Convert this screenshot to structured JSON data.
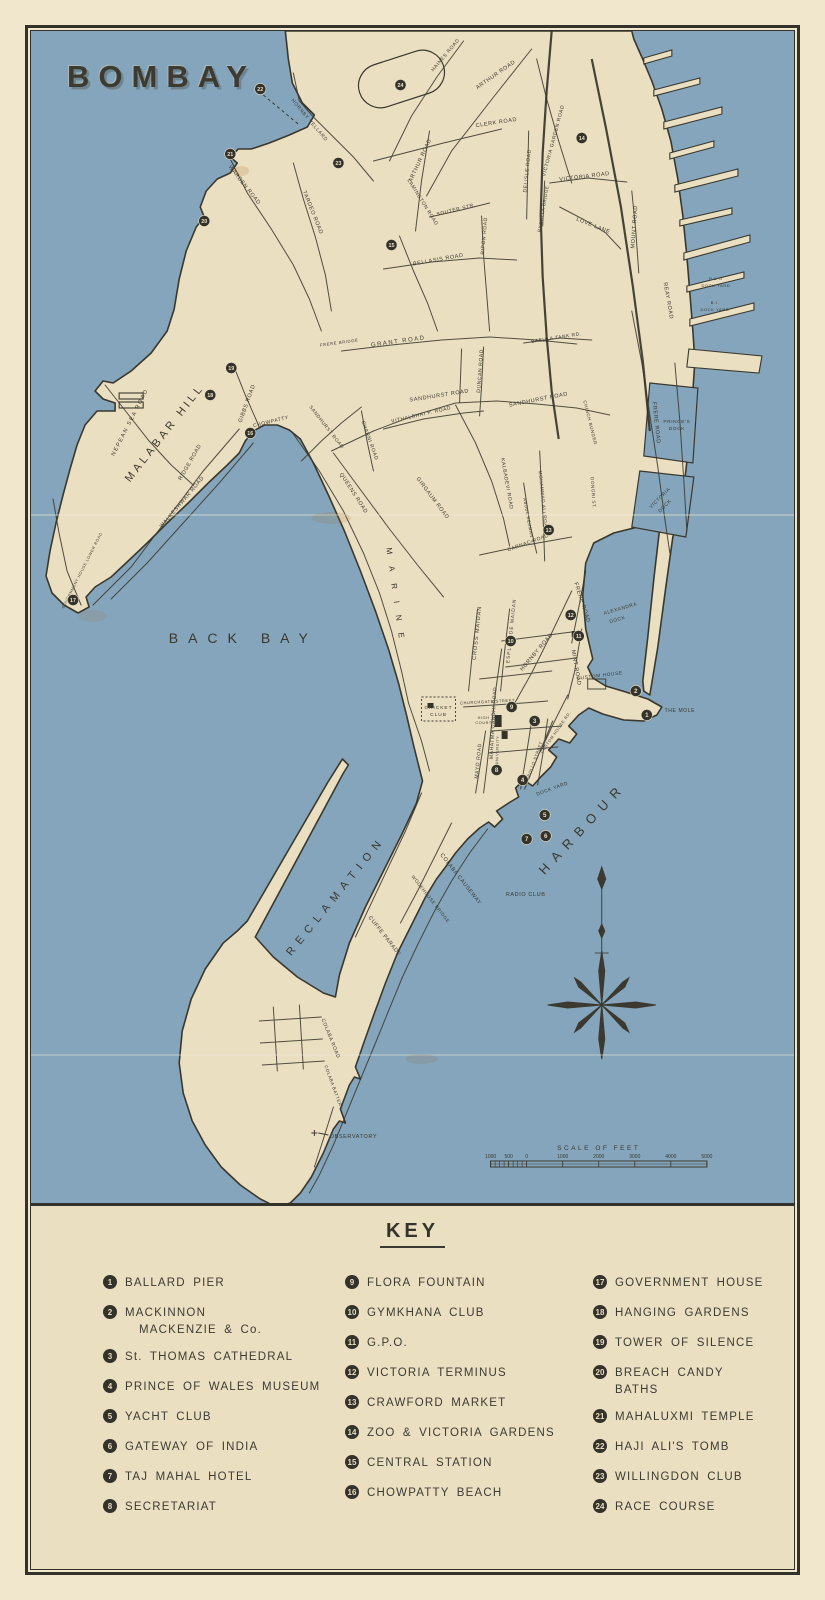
{
  "title": "BOMBAY",
  "map": {
    "colors": {
      "sea": "#84a5bb",
      "land": "#ebdfc1",
      "ink": "#3a382e",
      "paper": "#f0e7cd"
    },
    "area_labels_note": "labels use map svg coordinates",
    "labels": [
      {
        "t": "BACK BAY",
        "x": 212,
        "y": 612,
        "s": 14,
        "sp": 10
      },
      {
        "t": "MALABAR HILL",
        "x": 136,
        "y": 404,
        "r": -52,
        "s": 11,
        "sp": 3.5
      },
      {
        "t": "HARBOUR",
        "x": 554,
        "y": 800,
        "r": -47,
        "s": 13,
        "sp": 8
      },
      {
        "t": "RECLAMATION",
        "x": 307,
        "y": 867,
        "r": -51,
        "s": 11,
        "sp": 6.5
      },
      {
        "t": "HORNBY VELLARD",
        "x": 277,
        "y": 90,
        "r": 50,
        "s": 5
      },
      {
        "t": "CLERK ROAD",
        "x": 465,
        "y": 93,
        "r": -9,
        "s": 5.5
      },
      {
        "t": "ARTHUR ROAD",
        "x": 465,
        "y": 45,
        "r": -35,
        "s": 5.5
      },
      {
        "t": "ARTHUR ROAD",
        "x": 390,
        "y": 130,
        "r": -65,
        "s": 5.5
      },
      {
        "t": "HAINES ROAD",
        "x": 415,
        "y": 25,
        "r": -50,
        "s": 5
      },
      {
        "t": "LAMINGTON ROAD",
        "x": 390,
        "y": 172,
        "r": 58,
        "s": 5
      },
      {
        "t": "SOUTER STR.",
        "x": 425,
        "y": 180,
        "r": -14,
        "s": 5
      },
      {
        "t": "RIPON ROAD",
        "x": 454,
        "y": 205,
        "r": -85,
        "s": 5
      },
      {
        "t": "BELLASIS ROAD",
        "x": 407,
        "y": 230,
        "r": -10,
        "s": 5.5
      },
      {
        "t": "TARDEO ROAD",
        "x": 280,
        "y": 182,
        "r": 68,
        "s": 5.5
      },
      {
        "t": "WARDEN ROAD",
        "x": 212,
        "y": 155,
        "r": 52,
        "s": 5.5
      },
      {
        "t": "VICTORIA GARDEN ROAD",
        "x": 523,
        "y": 110,
        "r": -75,
        "s": 5
      },
      {
        "t": "DELISLE ROAD",
        "x": 497,
        "y": 140,
        "r": -84,
        "s": 5
      },
      {
        "t": "BYCULLA BRIDGE",
        "x": 513,
        "y": 178,
        "r": -80,
        "s": 4.5
      },
      {
        "t": "VICTORIA ROAD",
        "x": 553,
        "y": 147,
        "r": -7,
        "s": 5.5
      },
      {
        "t": "LOVE LANE",
        "x": 561,
        "y": 196,
        "r": 22,
        "s": 5.5
      },
      {
        "t": "MOUNT ROAD",
        "x": 604,
        "y": 196,
        "r": -86,
        "s": 5.5
      },
      {
        "t": "GRANT ROAD",
        "x": 367,
        "y": 312,
        "r": -8,
        "s": 6,
        "sp": 1.5
      },
      {
        "t": "FRERE BRIDGE",
        "x": 308,
        "y": 313,
        "r": -8,
        "s": 4.2
      },
      {
        "t": "BABULA TANK RD.",
        "x": 525,
        "y": 308,
        "r": -9,
        "s": 4.8
      },
      {
        "t": "SANDHURST ROAD",
        "x": 408,
        "y": 366,
        "r": -9,
        "s": 5.5
      },
      {
        "t": "SANDHURST ROAD",
        "x": 507,
        "y": 370,
        "r": -11,
        "s": 5.5
      },
      {
        "t": "SANDHURST ROAD",
        "x": 294,
        "y": 397,
        "r": 52,
        "s": 4.8
      },
      {
        "t": "VITHALBHAI P. ROAD",
        "x": 390,
        "y": 385,
        "r": -13,
        "s": 5
      },
      {
        "t": "CHARNI ROAD",
        "x": 337,
        "y": 410,
        "r": 70,
        "s": 5
      },
      {
        "t": "GIRGAUM ROAD",
        "x": 400,
        "y": 468,
        "r": 53,
        "s": 5.5
      },
      {
        "t": "QUEENS ROAD",
        "x": 321,
        "y": 463,
        "r": 57,
        "s": 5.5
      },
      {
        "t": "KALBADEVI ROAD",
        "x": 474,
        "y": 453,
        "r": 80,
        "s": 5
      },
      {
        "t": "MOHAMMAD ALI ROAD",
        "x": 510,
        "y": 470,
        "r": 84,
        "s": 4.6
      },
      {
        "t": "ABDUL REHMAN ST.",
        "x": 496,
        "y": 492,
        "r": 80,
        "s": 4.2
      },
      {
        "t": "DUNCAN ROAD",
        "x": 450,
        "y": 340,
        "r": -86,
        "s": 5
      },
      {
        "t": "CHINCH BUNDER",
        "x": 557,
        "y": 392,
        "r": 76,
        "s": 4.5
      },
      {
        "t": "DONGRI ST.",
        "x": 560,
        "y": 462,
        "r": 86,
        "s": 4.5
      },
      {
        "t": "CARNAC ROAD",
        "x": 497,
        "y": 513,
        "r": -20,
        "s": 5
      },
      {
        "t": "HORNBY ROAD",
        "x": 506,
        "y": 622,
        "r": -50,
        "s": 5.5
      },
      {
        "t": "MINT ROAD",
        "x": 543,
        "y": 637,
        "r": 80,
        "s": 5.5
      },
      {
        "t": "FRERE ROAD",
        "x": 549,
        "y": 572,
        "r": 72,
        "s": 5.5
      },
      {
        "t": "FRERE ROAD",
        "x": 623,
        "y": 392,
        "r": 84,
        "s": 5.5
      },
      {
        "t": "REAY ROAD",
        "x": 635,
        "y": 270,
        "r": 80,
        "s": 5.5
      },
      {
        "t": "MARINE",
        "x": 362,
        "y": 568,
        "r": 82,
        "s": 8,
        "sp": 12
      },
      {
        "t": "CROSS MAIDAN",
        "x": 447,
        "y": 602,
        "r": -84,
        "s": 5.5,
        "sp": 1
      },
      {
        "t": "ESPLANADE MAIDAN",
        "x": 481,
        "y": 600,
        "r": -84,
        "s": 4.8,
        "sp": 1
      },
      {
        "t": "MAHATMA GANDHI ROAD",
        "x": 463,
        "y": 692,
        "r": -87,
        "s": 5
      },
      {
        "t": "MAYO ROAD",
        "x": 448,
        "y": 730,
        "r": -84,
        "s": 5
      },
      {
        "t": "CUSTOM HOUSE RD.",
        "x": 525,
        "y": 702,
        "r": -55,
        "s": 4
      },
      {
        "t": "APOLLO STREET",
        "x": 504,
        "y": 730,
        "r": -70,
        "s": 4
      },
      {
        "t": "CHURCHGATE STREET",
        "x": 456,
        "y": 672,
        "r": -3,
        "s": 4
      },
      {
        "t": "NEPEAN SEA ROAD",
        "x": 100,
        "y": 392,
        "r": -63,
        "s": 5.5,
        "sp": 1.5
      },
      {
        "t": "RIDGE ROAD",
        "x": 160,
        "y": 432,
        "r": -60,
        "s": 5.5
      },
      {
        "t": "GIBBS ROAD",
        "x": 217,
        "y": 373,
        "r": -70,
        "s": 5.5
      },
      {
        "t": "WALKESHWAR ROAD",
        "x": 152,
        "y": 472,
        "r": -50,
        "s": 5.5
      },
      {
        "t": "CHOWPATTY",
        "x": 240,
        "y": 392,
        "r": -14,
        "s": 5
      },
      {
        "t": "GOVERNMENT HOUSE LOWER ROAD",
        "x": 52,
        "y": 540,
        "r": -63,
        "s": 3.8
      },
      {
        "t": "COLABA CAUSEWAY",
        "x": 428,
        "y": 849,
        "r": 52,
        "s": 5.5
      },
      {
        "t": "CUFFE PARADE",
        "x": 352,
        "y": 906,
        "r": 52,
        "s": 5.5
      },
      {
        "t": "WODEHOUSE BRIDGE",
        "x": 398,
        "y": 869,
        "r": 52,
        "s": 4.6
      },
      {
        "t": "COLABA ROAD",
        "x": 298,
        "y": 1008,
        "r": 68,
        "s": 5
      },
      {
        "t": "COLABA BATTERY",
        "x": 301,
        "y": 1057,
        "r": 70,
        "s": 4.4
      },
      {
        "t": "CUSTOM HOUSE",
        "x": 568,
        "y": 646,
        "r": -7,
        "s": 4.8
      },
      {
        "t": "THE MOLE",
        "x": 648,
        "y": 681,
        "s": 5
      },
      {
        "t": "RADIO CLUB",
        "x": 494,
        "y": 865,
        "s": 5.5
      },
      {
        "t": "OBSERVATORY",
        "x": 322,
        "y": 1107,
        "s": 5.5
      },
      {
        "t": "CRICKET",
        "x": 407,
        "y": 678,
        "s": 4.8,
        "sp": 1
      },
      {
        "t": "CLUB",
        "x": 407,
        "y": 685,
        "s": 4.8,
        "sp": 1
      },
      {
        "t": "HIGH",
        "x": 452,
        "y": 688,
        "s": 3.8
      },
      {
        "t": "COURT",
        "x": 452,
        "y": 693,
        "s": 3.8
      },
      {
        "t": "UNIVERSITY",
        "x": 467,
        "y": 719,
        "r": -88,
        "s": 3.8
      },
      {
        "t": "DOCK YARD",
        "x": 521,
        "y": 759,
        "r": -20,
        "s": 4.8
      },
      {
        "t": "PRINCE'S",
        "x": 645,
        "y": 392,
        "s": 4.8
      },
      {
        "t": "DOCK",
        "x": 645,
        "y": 399,
        "s": 4.8
      },
      {
        "t": "VICTORIA",
        "x": 629,
        "y": 468,
        "r": -45,
        "s": 4.8
      },
      {
        "t": "DOCK",
        "x": 634,
        "y": 476,
        "r": -45,
        "s": 4.8
      },
      {
        "t": "ALEXANDRA",
        "x": 589,
        "y": 579,
        "r": -16,
        "s": 4.8
      },
      {
        "t": "DOCK",
        "x": 586,
        "y": 590,
        "r": -16,
        "s": 4.8
      },
      {
        "t": "P & O",
        "x": 684,
        "y": 249,
        "s": 4
      },
      {
        "t": "DOCK YARD",
        "x": 684,
        "y": 256,
        "s": 4
      },
      {
        "t": "B.I.",
        "x": 683,
        "y": 273,
        "s": 4
      },
      {
        "t": "DOCK YARD",
        "x": 683,
        "y": 280,
        "s": 4
      }
    ],
    "markers": [
      {
        "n": "1",
        "x": 615,
        "y": 684
      },
      {
        "n": "2",
        "x": 604,
        "y": 660
      },
      {
        "n": "3",
        "x": 503,
        "y": 690
      },
      {
        "n": "4",
        "x": 491,
        "y": 749
      },
      {
        "n": "5",
        "x": 513,
        "y": 784
      },
      {
        "n": "6",
        "x": 514,
        "y": 805
      },
      {
        "n": "7",
        "x": 495,
        "y": 808
      },
      {
        "n": "8",
        "x": 465,
        "y": 739
      },
      {
        "n": "9",
        "x": 480,
        "y": 676
      },
      {
        "n": "10",
        "x": 479,
        "y": 610
      },
      {
        "n": "11",
        "x": 547,
        "y": 605
      },
      {
        "n": "12",
        "x": 539,
        "y": 584
      },
      {
        "n": "13",
        "x": 517,
        "y": 499
      },
      {
        "n": "14",
        "x": 550,
        "y": 107
      },
      {
        "n": "15",
        "x": 360,
        "y": 214
      },
      {
        "n": "16",
        "x": 219,
        "y": 402
      },
      {
        "n": "17",
        "x": 42,
        "y": 569
      },
      {
        "n": "18",
        "x": 179,
        "y": 364
      },
      {
        "n": "19",
        "x": 200,
        "y": 337
      },
      {
        "n": "20",
        "x": 173,
        "y": 190
      },
      {
        "n": "21",
        "x": 199,
        "y": 123
      },
      {
        "n": "22",
        "x": 229,
        "y": 58
      },
      {
        "n": "23",
        "x": 307,
        "y": 132
      },
      {
        "n": "24",
        "x": 369,
        "y": 54
      }
    ],
    "scale": {
      "title": "SCALE OF FEET",
      "ticks": [
        {
          "t": "1000",
          "x": 459
        },
        {
          "t": "500",
          "x": 477
        },
        {
          "t": "0",
          "x": 495
        },
        {
          "t": "1000",
          "x": 531
        },
        {
          "t": "2000",
          "x": 567
        },
        {
          "t": "3000",
          "x": 603
        },
        {
          "t": "4000",
          "x": 639
        },
        {
          "t": "5000",
          "x": 675
        }
      ]
    }
  },
  "key": {
    "title": "KEY",
    "columns": [
      [
        {
          "num": "1",
          "label": "BALLARD PIER"
        },
        {
          "num": "2",
          "label": "MACKINNON",
          "label2": "MACKENZIE & Co."
        },
        {
          "num": "3",
          "label": "St. THOMAS CATHEDRAL"
        },
        {
          "num": "4",
          "label": "PRINCE OF WALES MUSEUM"
        },
        {
          "num": "5",
          "label": "YACHT CLUB"
        },
        {
          "num": "6",
          "label": "GATEWAY OF INDIA"
        },
        {
          "num": "7",
          "label": "TAJ MAHAL HOTEL"
        },
        {
          "num": "8",
          "label": "SECRETARIAT"
        }
      ],
      [
        {
          "num": "9",
          "label": "FLORA FOUNTAIN"
        },
        {
          "num": "10",
          "label": "GYMKHANA CLUB"
        },
        {
          "num": "11",
          "label": "G.P.O."
        },
        {
          "num": "12",
          "label": "VICTORIA TERMINUS"
        },
        {
          "num": "13",
          "label": "CRAWFORD MARKET"
        },
        {
          "num": "14",
          "label": "ZOO & VICTORIA GARDENS"
        },
        {
          "num": "15",
          "label": "CENTRAL STATION"
        },
        {
          "num": "16",
          "label": "CHOWPATTY BEACH"
        }
      ],
      [
        {
          "num": "17",
          "label": "GOVERNMENT HOUSE"
        },
        {
          "num": "18",
          "label": "HANGING GARDENS"
        },
        {
          "num": "19",
          "label": "TOWER OF SILENCE"
        },
        {
          "num": "20",
          "label": "BREACH CANDY BATHS"
        },
        {
          "num": "21",
          "label": "MAHALUXMI TEMPLE"
        },
        {
          "num": "22",
          "label": "HAJI ALI'S TOMB"
        },
        {
          "num": "23",
          "label": "WILLINGDON CLUB"
        },
        {
          "num": "24",
          "label": "RACE COURSE"
        }
      ]
    ]
  }
}
